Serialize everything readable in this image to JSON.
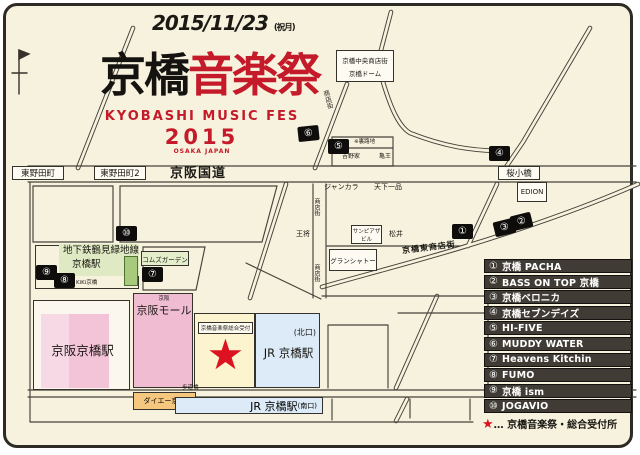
{
  "header": {
    "date": "2015/11/23",
    "date_note": "(祝月)",
    "title_black": "京橋",
    "title_red": "音楽祭",
    "subtitle": "KYOBASHI MUSIC FES",
    "year": "2015",
    "place": "OSAKA JAPAN"
  },
  "map": {
    "labels": {
      "higashinodacho": "東野田町",
      "higashinodacho2": "東野田町2",
      "keihan_kokudo": "京阪国道",
      "sakurakobashi": "桜小橋",
      "dome_line1": "京橋中央商店街",
      "dome_line2": "京橋ドーム",
      "shotengai": "商店街",
      "jankara": "ジャンカラ",
      "tenkaippin": "天下一品",
      "ohsho": "王将",
      "sunpiazza_line1": "サンピアザ",
      "sunpiazza_line2": "ビル",
      "matsui": "松井",
      "grand_chateau": "グランシャトー",
      "higashi_shotengai": "京橋東商店街",
      "edion": "EDION",
      "urarouji": "※裏路地",
      "yoshinoya": "吉野家",
      "kameou": "亀王",
      "metro_line": "地下鉄鶴見緑地線",
      "metro_station": "京橋駅",
      "kiki": "KiKi京橋",
      "comms_garden": "コムズガーデン",
      "keihan_small": "京阪",
      "keihan_mall": "京阪モール",
      "keihan_station": "京阪京橋駅",
      "uketsuke": "京橋音楽祭総合受付",
      "star": "★",
      "jr_station": "JR 京橋駅",
      "kitaguchi": "(北口)",
      "minamiguchi": "(南口)",
      "daiei": "ダイエー京橋",
      "hodokyo": "歩道橋"
    },
    "markers": [
      "①",
      "②",
      "③",
      "④",
      "⑤",
      "⑥",
      "⑦",
      "⑧",
      "⑨",
      "⑩"
    ]
  },
  "legend": {
    "items": [
      {
        "num": "①",
        "label": "京橋 PACHA"
      },
      {
        "num": "②",
        "label": "BASS ON TOP 京橋"
      },
      {
        "num": "③",
        "label": "京橋ベロニカ"
      },
      {
        "num": "④",
        "label": "京橋セブンデイズ"
      },
      {
        "num": "⑤",
        "label": "HI-FIVE"
      },
      {
        "num": "⑥",
        "label": "MUDDY WATER"
      },
      {
        "num": "⑦",
        "label": "Heavens Kitchin"
      },
      {
        "num": "⑧",
        "label": "FUMO"
      },
      {
        "num": "⑨",
        "label": "京橋 ism"
      },
      {
        "num": "⑩",
        "label": "JOGAVIO"
      }
    ],
    "note_star": "★",
    "note_text": "… 京橋音楽祭・総合受付所"
  },
  "colors": {
    "red": "#c41a2a",
    "star_red": "#dc1220",
    "pink": "#f0bcd2",
    "pale_pink": "#f5cfdf",
    "yellow": "#fcf4cf",
    "blue": "#dcebf7",
    "orange": "#f6c87f",
    "green": "#dfe9c3",
    "legend_bar": "#403c35"
  }
}
